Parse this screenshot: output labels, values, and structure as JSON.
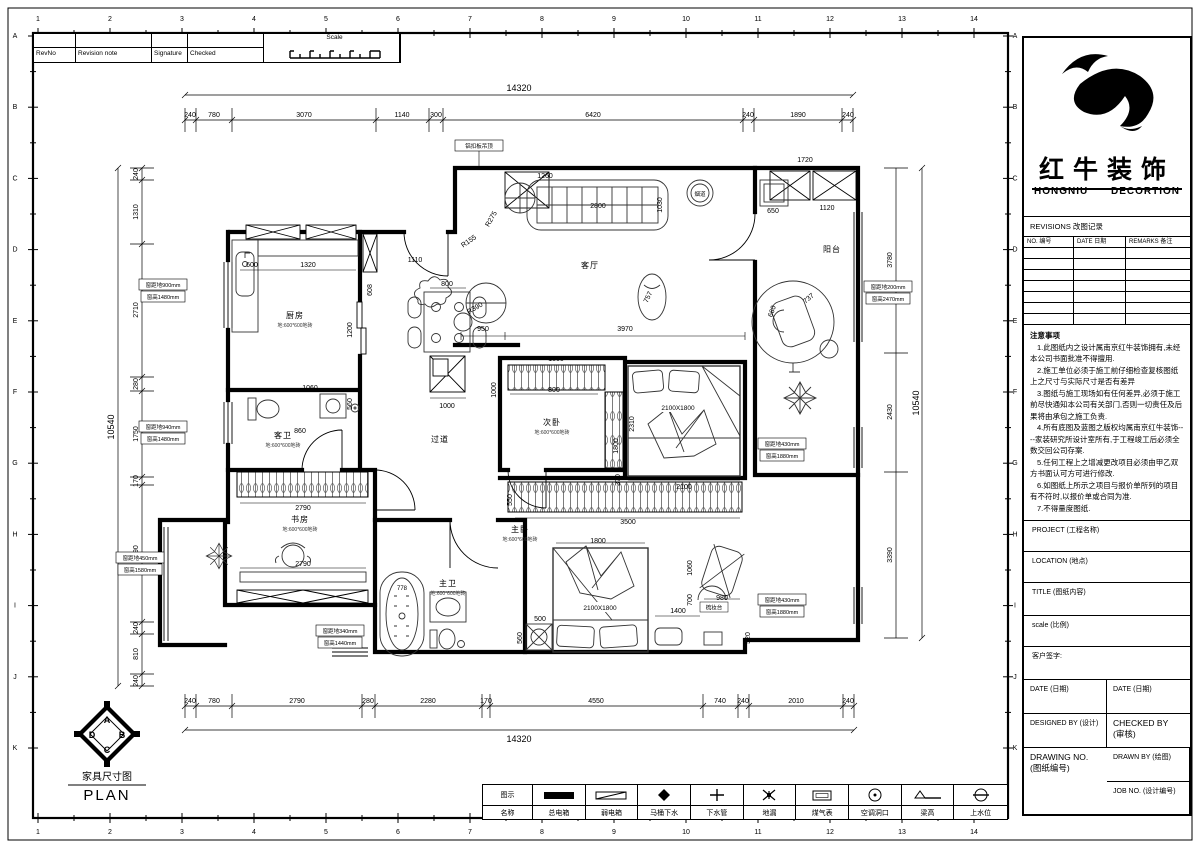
{
  "sheet": {
    "border_numbers": [
      "1",
      "2",
      "3",
      "4",
      "5",
      "6",
      "7",
      "8",
      "9",
      "10",
      "11",
      "12",
      "13",
      "14"
    ],
    "border_letters": [
      "A",
      "B",
      "C",
      "D",
      "E",
      "F",
      "G",
      "H",
      "I",
      "J",
      "K"
    ]
  },
  "revision_strip": {
    "rev_no": "RevNo",
    "revision_note": "Revision note",
    "signature": "Signature",
    "checked": "Checked",
    "scale": "Scale"
  },
  "brand": {
    "name_cn": "红牛装饰",
    "name_en_left": "HONGNIU",
    "name_en_right": "DECORTION"
  },
  "revisions_table": {
    "header": "REVISIONS 改图记录",
    "columns": [
      "NO. 编号",
      "DATE 日期",
      "REMARKS 备注"
    ]
  },
  "notes": {
    "title": "注意事项",
    "items": [
      "1.此图纸内之设计属南京红牛装饰拥有,未经本公司书面批准不得擅用.",
      "2.施工单位必须于施工前仔细检查复核图纸上之尺寸与实际尺寸是否有差异",
      "3.图纸与施工现场如有任何差异,必须于施工前尽快通知本公司有关部门,否则一切责任及后果将由承包之施工负责.",
      "4.所有底图及蓝图之版权均属南京红牛装饰----家装研究所设计室所有,于工程竣工后必须全数交回公司存案.",
      "5.任何工程上之增减更改项目必须由甲乙双方书面认可方可进行修改.",
      "6.如图纸上所示之项目与报价单所列的项目有不符时,以报价单或合同为准.",
      "7.不得量度图纸."
    ]
  },
  "title_fields": {
    "project": "PROJECT (工程名称)",
    "location": "LOCATION (地点)",
    "title": "TITLE (图纸内容)",
    "scale": "scale  (比例)",
    "client_sign": "客户签字:",
    "date_left": "DATE (日期)",
    "date_right": "DATE (日期)",
    "designed_by": "DESIGNED BY (设计)",
    "checked_by": "CHECKED BY\n(审核)",
    "drawn_by": "DRAWN BY (绘图)",
    "drawing_no": "DRAWING NO.\n(图纸编号)",
    "job_no": "JOB NO. (设计编号)"
  },
  "legend": {
    "symbol_header": "图示",
    "name_header": "名称",
    "items": [
      "总电箱",
      "弱电箱",
      "马桶下水",
      "下水管",
      "地漏",
      "煤气表",
      "空调洞口",
      "梁高",
      "上水位"
    ]
  },
  "plan_title": {
    "cn": "家具尺寸图",
    "en": "PLAN",
    "compass": {
      "top": "A",
      "right": "B",
      "bottom": "C",
      "left": "D"
    }
  },
  "dims": {
    "top_total": "14320",
    "top": [
      "240",
      "780",
      "3070",
      "1140",
      "300",
      "6420",
      "240",
      "1890",
      "240"
    ],
    "bottom": [
      "240",
      "780",
      "2790",
      "280",
      "2280",
      "170",
      "4550",
      "740",
      "240",
      "2010",
      "240"
    ],
    "bottom_total": "14320",
    "left": [
      "240",
      "1310",
      "2710",
      "280",
      "1750",
      "170",
      "2790",
      "240",
      "810",
      "240"
    ],
    "left_total": "10540",
    "right": [
      "3780",
      "2430",
      "3390"
    ],
    "right_total": "10540"
  },
  "rooms": {
    "kitchen": {
      "name": "厨房",
      "note": "地:600*600地砖"
    },
    "living": {
      "name": "客厅"
    },
    "balcony": {
      "name": "阳台"
    },
    "guest_bath": {
      "name": "客卫",
      "note": "地:600*600地砖"
    },
    "hallway": {
      "name": "过道"
    },
    "bedroom2": {
      "name": "次卧",
      "note": "地:600*600地砖"
    },
    "study": {
      "name": "书房",
      "note": "地:600*600地砖"
    },
    "master": {
      "name": "主卧",
      "note": "地:600*600地砖"
    },
    "master_bath": {
      "name": "主卫",
      "note": "地:600*600地砖"
    },
    "flue": "烟道",
    "dresser": "梳妆台",
    "ceiling_note": "铝扣板吊顶"
  },
  "beds": {
    "b1": "2100X1800",
    "b2": "2100X1800"
  },
  "inner_dims": {
    "d1720": "1720",
    "d1260": "1260",
    "d2800": "2800",
    "d1030": "1030",
    "d650": "650",
    "d1120": "1120",
    "d950": "950",
    "d3970": "3970",
    "dR390": "R390",
    "dR275": "R275",
    "dR155": "R155",
    "d757": "757",
    "d600": "600",
    "d1320": "1320",
    "d1110": "1110",
    "d608": "608",
    "d1200": "1200",
    "d800t": "800",
    "d1000t": "1000",
    "d860": "860",
    "d1060": "1060",
    "d560": "560",
    "d1500": "1500",
    "d800w": "800",
    "d1800v": "1800",
    "d1000v": "1000",
    "d2310": "2310",
    "d2100": "2100",
    "d370": "370",
    "d3500": "3500",
    "d550": "550",
    "d2790a": "2790",
    "d2790b": "2790",
    "d1800m": "1800",
    "d500": "500",
    "d560s": "560",
    "d1400": "1400",
    "d700": "700",
    "d520": "520",
    "d980": "980",
    "d1060v": "1060",
    "d778": "778",
    "d660": "660",
    "d737": "737"
  },
  "window_notes": [
    {
      "l1": "窗距地900mm",
      "l2": "窗高1480mm"
    },
    {
      "l1": "窗距地940mm",
      "l2": "窗高1480mm"
    },
    {
      "l1": "窗距地450mm",
      "l2": "窗高1580mm"
    },
    {
      "l1": "窗距地340mm",
      "l2": "窗高1440mm"
    },
    {
      "l1": "窗距地200mm",
      "l2": "窗高2470mm"
    },
    {
      "l1": "窗距地430mm",
      "l2": "窗高1880mm"
    },
    {
      "l1": "窗距地430mm",
      "l2": "窗高1880mm"
    }
  ]
}
